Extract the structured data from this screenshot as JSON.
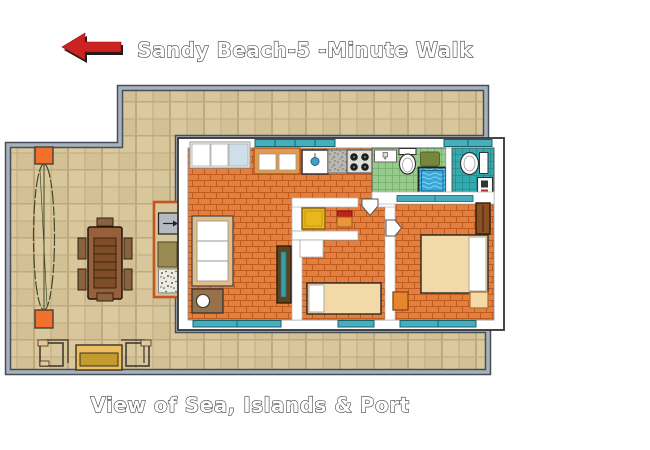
{
  "header": {
    "title": "Sandy Beach-5 -Minute Walk",
    "arrow_direction": "left",
    "arrow_color": "#cc2222"
  },
  "footer": {
    "caption": "View of Sea, Islands & Port"
  },
  "palette": {
    "page_background": "#ffffff",
    "terrace_tile": "#d8c69c",
    "terrace_grout": "#c0a97e",
    "outer_wall_dark": "#454f59",
    "outer_wall_gray": "#a9b2bb",
    "interior_wall": "#ffffff",
    "living_floor_brick": "#e2813f",
    "brick_joint": "#c05a1e",
    "bathroom_green_tile": "#96cb8c",
    "bathroom_teal_tile": "#34a9ae",
    "window_glass_teal": "#49aebc",
    "planter_orange": "#f0702c",
    "bed_cream": "#f3d9a8",
    "table_brown": "#96613a",
    "desk_yellow": "#e9b71c",
    "shower_water_blue": "#38a8d8"
  },
  "rooms": [
    {
      "id": "terrace",
      "floor": "beige ceramic tile"
    },
    {
      "id": "living-room-kitchen",
      "floor": "orange brick tile"
    },
    {
      "id": "bathroom-green",
      "floor": "green tile"
    },
    {
      "id": "bathroom-teal",
      "floor": "teal tile"
    },
    {
      "id": "bedroom-single",
      "floor": "orange brick tile"
    },
    {
      "id": "bedroom-double",
      "floor": "orange brick tile"
    }
  ],
  "furniture": [
    "red-direction-arrow",
    "plant-between-planters",
    "orange-planters",
    "outdoor-dining-table",
    "six-dining-chairs",
    "deck-chair-left",
    "outdoor-bench",
    "deck-chair-right",
    "ac-unit",
    "storage-box",
    "pebble-pad",
    "sofa",
    "lamp-side-table",
    "mirror-cabinet",
    "window-cupboard",
    "kitchen-cabinet",
    "kitchen-sink",
    "gray-counter",
    "stove-four-burners",
    "washbasin-green-bath",
    "toilet-green-bath",
    "bath-mat",
    "shower-tub",
    "toilet-teal-bath",
    "washbasin-teal-bath",
    "yellow-desk",
    "red-chair",
    "wall-shelf",
    "single-bed",
    "double-bed",
    "wardrobe",
    "nightstand-orange",
    "nightstand-cream",
    "sliding-glass-windows"
  ]
}
